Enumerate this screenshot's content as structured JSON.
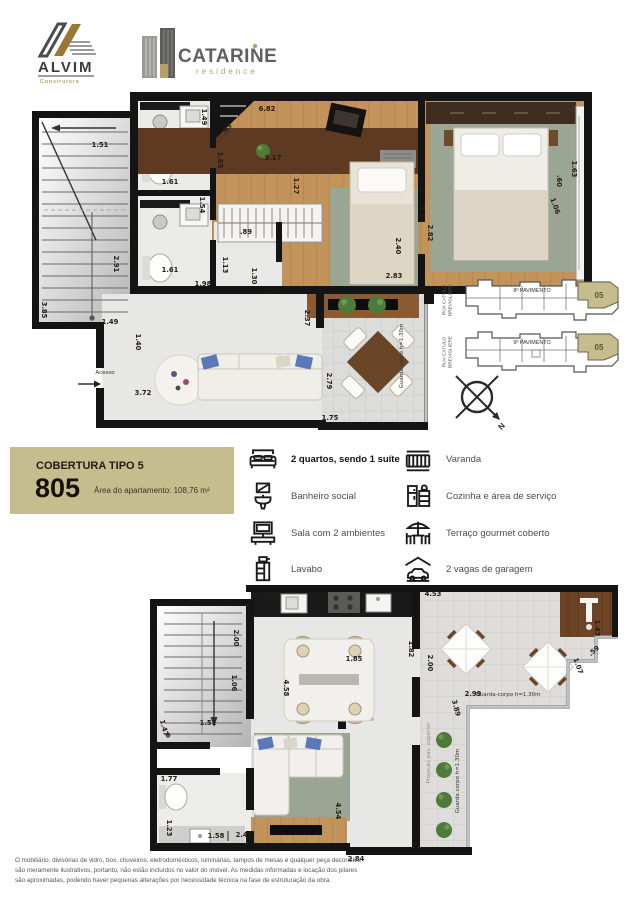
{
  "header": {
    "alvim_name": "ALVIM",
    "alvim_sub": "Construtora",
    "catarine_name": "CATARINE",
    "catarine_sub": "residence"
  },
  "info_box": {
    "type_label": "COBERTURA TIPO 5",
    "unit_number": "805",
    "area_label": "Área do apartamento: 108,76 m²"
  },
  "features": {
    "left": [
      {
        "label": "2 quartos, sendo 1 suíte"
      },
      {
        "label": "Banheiro social"
      },
      {
        "label": "Sala com 2 ambientes"
      },
      {
        "label": "Lavabo"
      }
    ],
    "right": [
      {
        "label": "Varanda"
      },
      {
        "label": "Cozinha e área de serviço"
      },
      {
        "label": "Terraço gourmet coberto"
      },
      {
        "label": "2 vagas de garagem"
      }
    ]
  },
  "key_plans": {
    "street_label": "RUA CATULO BREVIGLIERE",
    "floor_8_label": "8º PAVIMENTO",
    "floor_9_label": "9º PAVIMENTO",
    "unit_highlight": "05",
    "compass_north": "N"
  },
  "upper_plan": {
    "acesso_label": "Acesso",
    "guard_rail_label": "Guarda corpo h=1.30m",
    "dimensions": [
      {
        "t": "1.51",
        "x": 70,
        "y": 53
      },
      {
        "t": "6.82",
        "x": 237,
        "y": 17
      },
      {
        "t": ".93",
        "x": 197,
        "y": 37,
        "r": -52
      },
      {
        "t": "1.49",
        "x": 174,
        "y": 25,
        "r": 90
      },
      {
        "t": "3.17",
        "x": 243,
        "y": 66
      },
      {
        "t": "1.65",
        "x": 190,
        "y": 68,
        "r": 90
      },
      {
        "t": "1.27",
        "x": 266,
        "y": 94,
        "r": 90
      },
      {
        "t": "1.61",
        "x": 140,
        "y": 90
      },
      {
        "t": "1.54",
        "x": 172,
        "y": 113,
        "r": 90
      },
      {
        "t": "1.61",
        "x": 140,
        "y": 178
      },
      {
        "t": "2.91",
        "x": 86,
        "y": 172,
        "r": 90
      },
      {
        "t": "3.85",
        "x": 14,
        "y": 218,
        "r": 90
      },
      {
        "t": ".89",
        "x": 216,
        "y": 140
      },
      {
        "t": "1.13",
        "x": 195,
        "y": 173,
        "r": 90
      },
      {
        "t": "1.30",
        "x": 224,
        "y": 184,
        "r": 90
      },
      {
        "t": "1.98",
        "x": 173,
        "y": 192
      },
      {
        "t": "1.05",
        "x": 242,
        "y": 200
      },
      {
        "t": "2.37",
        "x": 277,
        "y": 226,
        "r": 90
      },
      {
        "t": "1.49",
        "x": 80,
        "y": 230
      },
      {
        "t": "1.40",
        "x": 108,
        "y": 250,
        "r": 90
      },
      {
        "t": "3.72",
        "x": 113,
        "y": 301
      },
      {
        "t": "2.79",
        "x": 299,
        "y": 289,
        "r": 90
      },
      {
        "t": "1.75",
        "x": 300,
        "y": 326
      },
      {
        "t": "2.83",
        "x": 364,
        "y": 184
      },
      {
        "t": "2.40",
        "x": 368,
        "y": 154,
        "r": 90
      },
      {
        "t": "1.44",
        "x": 392,
        "y": 122,
        "r": 90
      },
      {
        "t": "2.82",
        "x": 400,
        "y": 141,
        "r": 90
      },
      {
        "t": "1.63",
        "x": 544,
        "y": 77,
        "r": 90
      },
      {
        "t": ".60",
        "x": 529,
        "y": 89,
        "r": 90
      },
      {
        "t": "1.06",
        "x": 525,
        "y": 114,
        "r": 70
      }
    ]
  },
  "lower_plan": {
    "guard_rail_label_top": "Guarda-corpo h=1.30m",
    "guard_rail_label_side": "Guarda corpo h=1.30m",
    "projection_label": "Projeção pav. superior",
    "dimensions": [
      {
        "t": "3.08",
        "x": 121,
        "y": 11
      },
      {
        "t": "2.00",
        "x": 86,
        "y": 53,
        "r": 90
      },
      {
        "t": "1.06",
        "x": 84,
        "y": 98,
        "r": 90
      },
      {
        "t": "1.51",
        "x": 58,
        "y": 138
      },
      {
        "t": "1.47",
        "x": 14,
        "y": 143,
        "r": 75
      },
      {
        "t": "1.85",
        "x": 204,
        "y": 74
      },
      {
        "t": "4.58",
        "x": 136,
        "y": 103,
        "r": 90
      },
      {
        "t": "1.82",
        "x": 261,
        "y": 64,
        "r": 90
      },
      {
        "t": "4.53",
        "x": 283,
        "y": 9
      },
      {
        "t": "2.00",
        "x": 280,
        "y": 78,
        "r": 90
      },
      {
        "t": "1.43",
        "x": 447,
        "y": 43,
        "r": 90
      },
      {
        "t": ".59",
        "x": 444,
        "y": 66,
        "r": -40
      },
      {
        "t": "1.07",
        "x": 428,
        "y": 81,
        "r": 70
      },
      {
        "t": "2.99",
        "x": 323,
        "y": 109
      },
      {
        "t": "3.89",
        "x": 306,
        "y": 123,
        "r": 75
      },
      {
        "t": "1.77",
        "x": 19,
        "y": 194
      },
      {
        "t": "1.23",
        "x": 19,
        "y": 243,
        "r": 90
      },
      {
        "t": "1.58",
        "x": 66,
        "y": 251
      },
      {
        "t": "2.43",
        "x": 94,
        "y": 250
      },
      {
        "t": "4.54",
        "x": 188,
        "y": 226,
        "r": 90
      },
      {
        "t": "2.84",
        "x": 206,
        "y": 274
      }
    ]
  },
  "disclaimer_lines": [
    "O mobiliário, divisórias de vidro, box, chuveiros, eletrodomésticos, luminárias, tampos de mesas e qualquer peça decorativa",
    "são meramente ilustrativos, portanto, não estão incluídos no valor do imóvel. As medidas informadas e locação dos pilares",
    "são aproximadas, podendo haver pequenas alterações por necessidade técnica na fase de estruturação da obra."
  ],
  "colors": {
    "accent_tan": "#c6bd8f",
    "wall": "#141414",
    "wood": "#c2935a",
    "rug": "#9ba593"
  }
}
